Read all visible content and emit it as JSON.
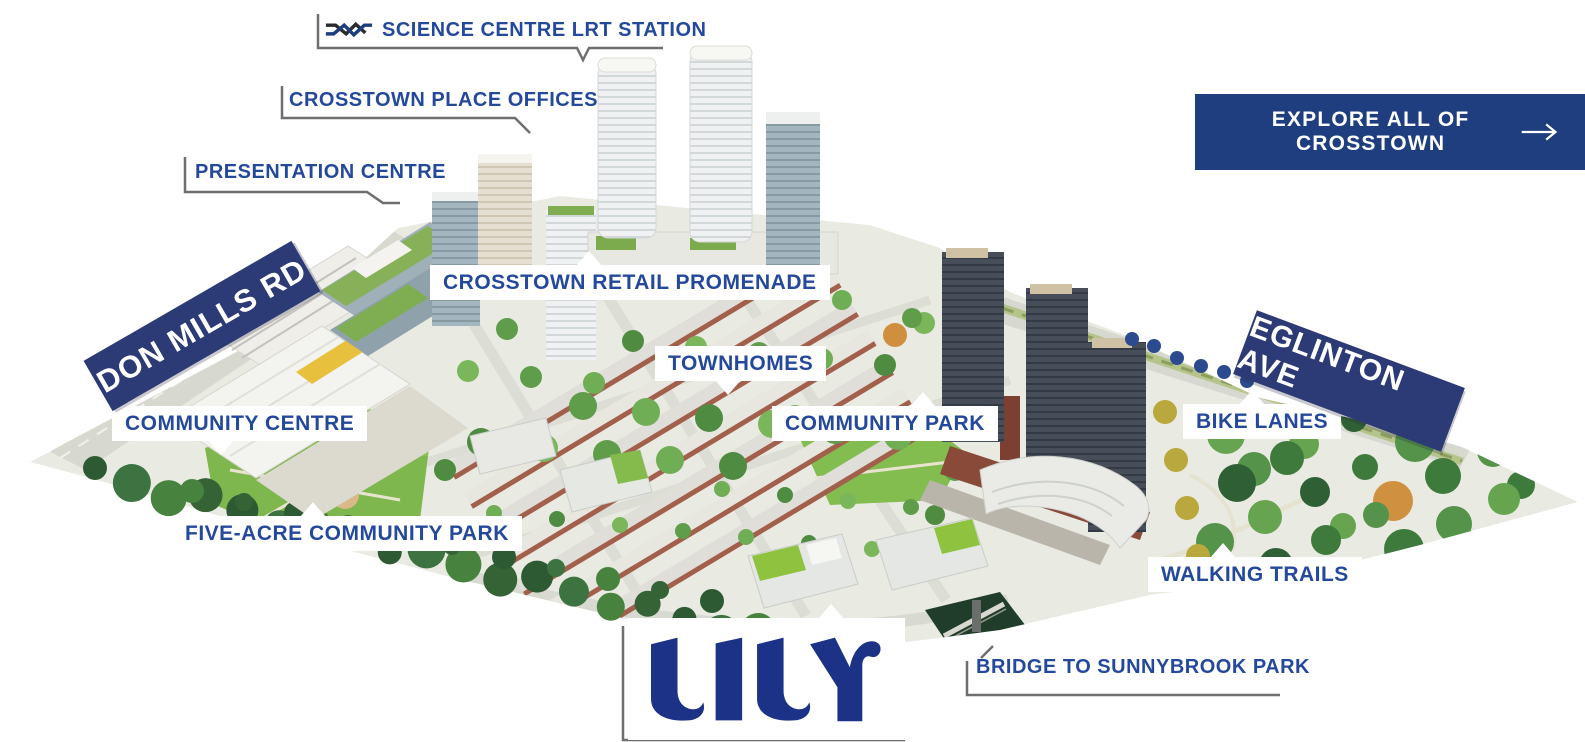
{
  "page": {
    "background_color": "#ffffff"
  },
  "colors": {
    "label_blue": "#24499c",
    "banner_navy": "#2c3a75",
    "button_navy": "#1f3e7f",
    "logo_navy": "#1b3287",
    "bracket_gray": "#6f6f6f",
    "bike_dot_navy": "#2c4b8e"
  },
  "cta_button": {
    "label": "EXPLORE ALL OF CROSSTOWN",
    "icon": "arrow-right-icon"
  },
  "road_banners": {
    "don_mills": {
      "label": "DON MILLS RD"
    },
    "eglinton": {
      "label": "EGLINTON AVE"
    }
  },
  "callouts": {
    "science_centre_lrt_station": {
      "label": "SCIENCE CENTRE LRT STATION",
      "style": "bracket",
      "icon": "crosstown-lrt-logo-icon"
    },
    "crosstown_place_offices": {
      "label": "CROSSTOWN PLACE OFFICES",
      "style": "bracket"
    },
    "presentation_centre": {
      "label": "PRESENTATION CENTRE",
      "style": "bracket"
    },
    "crosstown_retail_promenade": {
      "label": "CROSSTOWN RETAIL PROMENADE",
      "style": "box"
    },
    "townhomes": {
      "label": "TOWNHOMES",
      "style": "box"
    },
    "community_park": {
      "label": "COMMUNITY PARK",
      "style": "box"
    },
    "community_centre": {
      "label": "COMMUNITY CENTRE",
      "style": "box"
    },
    "five_acre_community_park": {
      "label": "FIVE-ACRE COMMUNITY PARK",
      "style": "box"
    },
    "bike_lanes": {
      "label": "BIKE LANES",
      "style": "box"
    },
    "walking_trails": {
      "label": "WALKING TRAILS",
      "style": "box"
    },
    "bridge_to_sunnybrook_park": {
      "label": "BRIDGE TO SUNNYBROOK PARK",
      "style": "bracket"
    }
  },
  "logo": {
    "text": "LILY"
  },
  "map": {
    "bike_lane_dots_count": 6
  }
}
